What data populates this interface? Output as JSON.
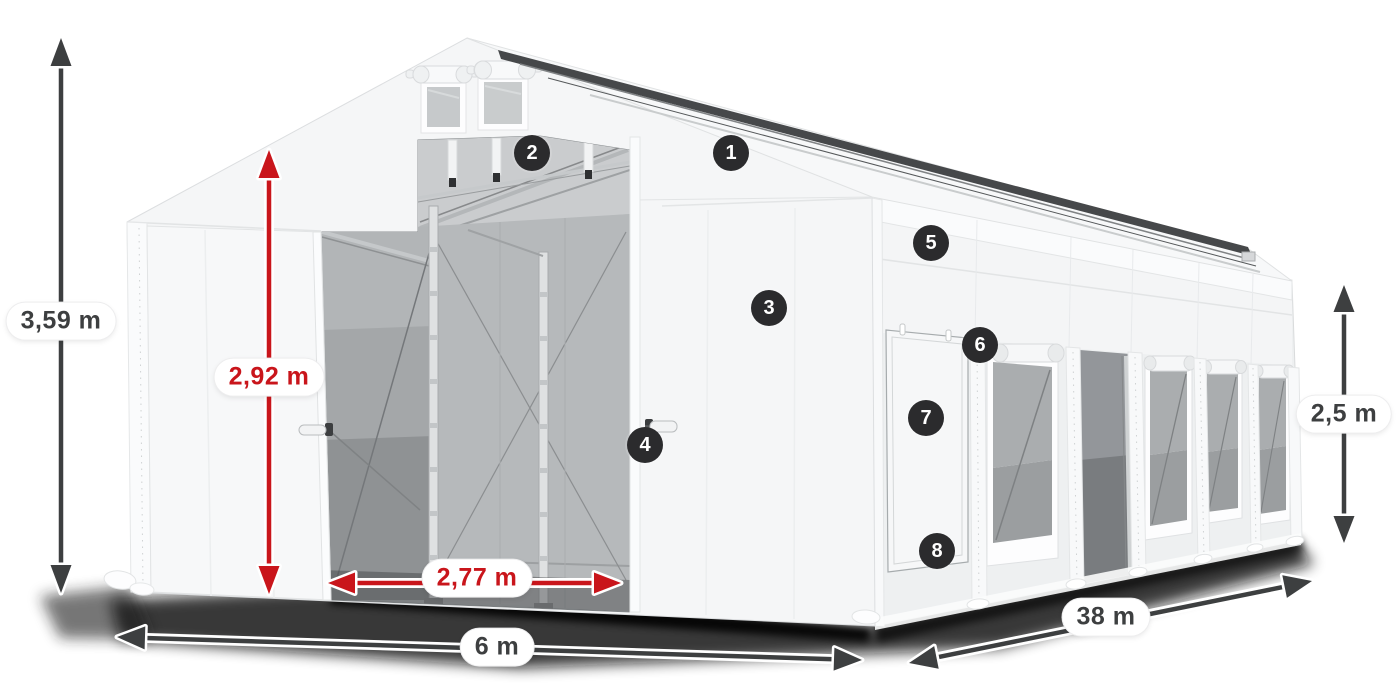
{
  "diagram": {
    "subject": "White storage tent shown in perspective with open front gate, roof vents, side windows, dimension arrows and numbered part callouts",
    "background_color": "#ffffff"
  },
  "dimensions": {
    "total_height": "3,59 m",
    "gate_height": "2,92 m",
    "gate_width": "2,77 m",
    "front_width": "6 m",
    "side_length": "38 m",
    "side_wall_height": "2,5 m"
  },
  "callouts": [
    "1",
    "2",
    "3",
    "4",
    "5",
    "6",
    "7",
    "8"
  ],
  "colors": {
    "dimension_primary": "#3d3f40",
    "dimension_accent_red": "#c9151b",
    "callout_background": "#2b2b2d",
    "callout_number": "#ffffff",
    "label_background": "#ffffff",
    "tent_white": "#f5f6f7",
    "interior_gray": "#a4a7a9",
    "shadow_black": "#0d0d0d"
  }
}
